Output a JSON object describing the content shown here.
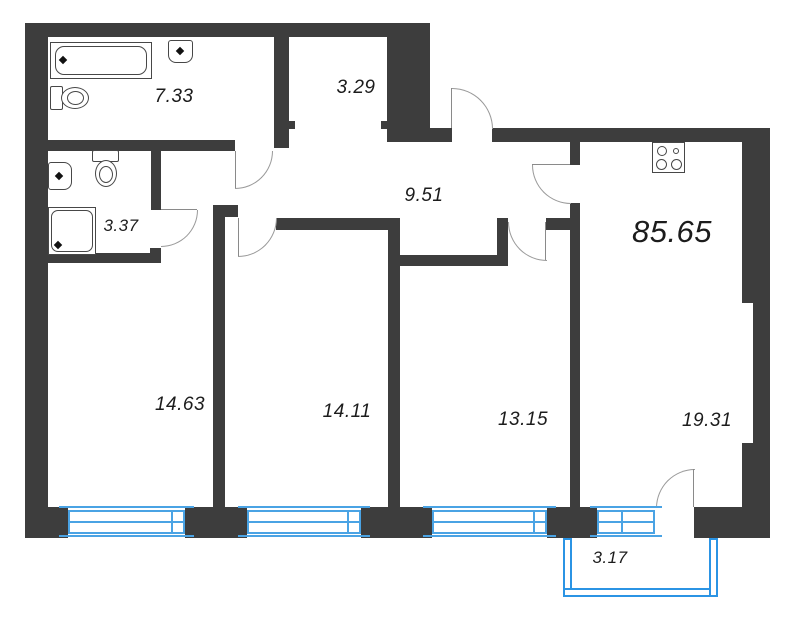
{
  "floorplan": {
    "type": "apartment-floor-plan",
    "total_area": "85.65",
    "rooms": [
      {
        "name": "bathroom",
        "area": "7.33"
      },
      {
        "name": "storage",
        "area": "3.29"
      },
      {
        "name": "hallway",
        "area": "9.51"
      },
      {
        "name": "wc",
        "area": "3.37"
      },
      {
        "name": "bedroom-1",
        "area": "14.63"
      },
      {
        "name": "bedroom-2",
        "area": "14.11"
      },
      {
        "name": "bedroom-3",
        "area": "13.15"
      },
      {
        "name": "kitchen-living",
        "area": "19.31"
      },
      {
        "name": "balcony",
        "area": "3.17"
      }
    ],
    "fixtures": [
      "bathtub-icon",
      "washbasin-icon",
      "toilet-icon",
      "shower-icon",
      "stove-icon"
    ],
    "colors": {
      "wall": "#3d3d3d",
      "window": "#4aa3e4",
      "balcony": "#2b94e4",
      "door_arc": "#999999",
      "label": "#1c1c1c"
    }
  }
}
